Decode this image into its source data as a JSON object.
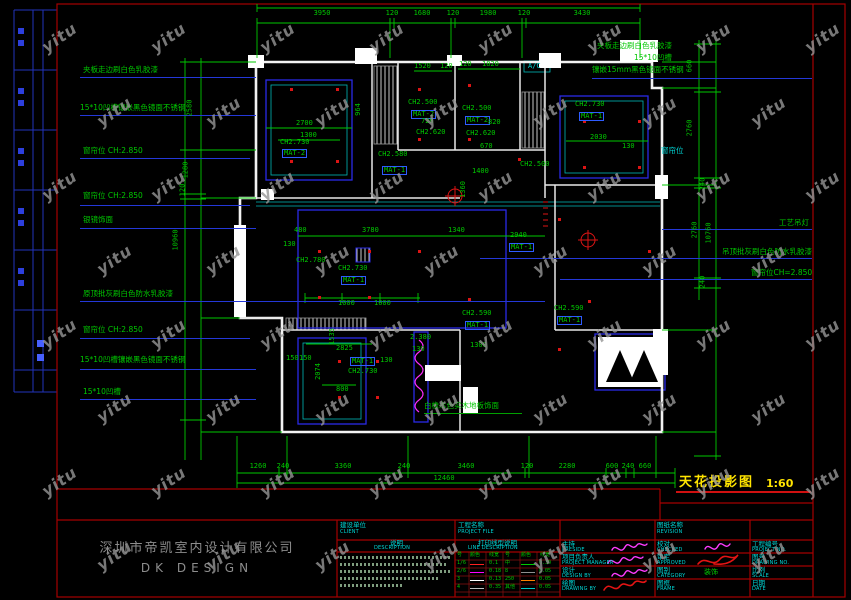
{
  "watermark": {
    "text": "yitu"
  },
  "drawing_title": {
    "name": "天花投影图",
    "scale": "1:60"
  },
  "company": {
    "cn": "深圳市帝凯室内设计有限公司",
    "en": "DK    DESIGN"
  },
  "colors": {
    "dim_green": "#00c800",
    "line_cyan": "#00c2c2",
    "wall_white": "#f2f2f2",
    "frame_red": "#a50000",
    "accent_blue": "#2a2ae6",
    "highlight_yellow": "#ffe400",
    "signature_magenta": "#ff3cff",
    "watermark_gray": "#969696"
  },
  "annotations": {
    "left": [
      {
        "t": "夹板走边刷白色乳胶漆",
        "x": 83,
        "y": 66,
        "ly": 77,
        "lx1": 80,
        "lx2": 256
      },
      {
        "t": "15*10凹槽镶嵌黑色镜面不锈钢",
        "x": 80,
        "y": 104,
        "ly": 115,
        "lx1": 80,
        "lx2": 256
      },
      {
        "t": "窗帘位 CH:2.850",
        "x": 83,
        "y": 147,
        "ly": 158,
        "lx1": 80,
        "lx2": 250
      },
      {
        "t": "窗帘位 CH:2.850",
        "x": 83,
        "y": 192,
        "ly": 205,
        "lx1": 80,
        "lx2": 250
      },
      {
        "t": "银镜饰面",
        "x": 83,
        "y": 216,
        "ly": 228,
        "lx1": 80,
        "lx2": 256
      },
      {
        "t": "原顶批灰刷白色防水乳胶漆",
        "x": 83,
        "y": 290,
        "ly": 301,
        "lx1": 80,
        "lx2": 545
      },
      {
        "t": "窗帘位 CH:2.850",
        "x": 83,
        "y": 326,
        "ly": 338,
        "lx1": 80,
        "lx2": 250
      },
      {
        "t": "15*10凹槽镶嵌黑色镜面不锈钢",
        "x": 80,
        "y": 356,
        "ly": 369,
        "lx1": 80,
        "lx2": 256
      },
      {
        "t": "15*10凹槽",
        "x": 83,
        "y": 388,
        "ly": 399,
        "lx1": 80,
        "lx2": 256
      }
    ],
    "right": [
      {
        "t": "夹板走边刷白色乳胶漆",
        "x": 597,
        "y": 42
      },
      {
        "t": "15*10凹槽",
        "x": 634,
        "y": 54
      },
      {
        "t": "镶嵌15mm黑色镜面不锈钢",
        "x": 592,
        "y": 66,
        "ly": 78,
        "lx1": 592,
        "lx2": 812
      },
      {
        "t": "窗帘位",
        "x": 661,
        "y": 147,
        "c": "cy"
      },
      {
        "t": "工艺吊灯",
        "x": 779,
        "y": 219,
        "ly": 229,
        "lx1": 662,
        "lx2": 812
      },
      {
        "t": "吊顶批灰刷白色防水乳胶漆",
        "x": 722,
        "y": 248,
        "ly": 258,
        "lx1": 480,
        "lx2": 812
      },
      {
        "t": "窗帘位CH=2.850",
        "x": 751,
        "y": 269,
        "ly": 279,
        "lx1": 560,
        "lx2": 812
      }
    ]
  },
  "floor_note": {
    "t": "白橡本色实木地板饰面",
    "x": 424,
    "y": 402,
    "uy": 413,
    "ux1": 424,
    "ux2": 522
  },
  "dims": {
    "top": [
      {
        "t": "3950",
        "x": 322
      },
      {
        "t": "120",
        "x": 392
      },
      {
        "t": "1680",
        "x": 422
      },
      {
        "t": "120",
        "x": 453
      },
      {
        "t": "1980",
        "x": 488
      },
      {
        "t": "120",
        "x": 524
      },
      {
        "t": "3430",
        "x": 582
      }
    ],
    "top_y": 10,
    "bottom": [
      {
        "t": "1260",
        "x": 258
      },
      {
        "t": "240",
        "x": 283
      },
      {
        "t": "3360",
        "x": 343
      },
      {
        "t": "240",
        "x": 404
      },
      {
        "t": "3460",
        "x": 466
      },
      {
        "t": "120",
        "x": 527
      },
      {
        "t": "2280",
        "x": 567
      },
      {
        "t": "600",
        "x": 612
      },
      {
        "t": "240",
        "x": 628
      },
      {
        "t": "660",
        "x": 645
      }
    ],
    "bottom_y": 463,
    "bottom_total": {
      "t": "12460",
      "x": 444,
      "y": 475
    },
    "left": [
      {
        "t": "2580",
        "x": 190,
        "y": 108
      },
      {
        "t": "1280",
        "x": 186,
        "y": 170
      },
      {
        "t": "120",
        "x": 183,
        "y": 190
      },
      {
        "t": "10960",
        "x": 176,
        "y": 240
      }
    ],
    "right": [
      {
        "t": "660",
        "x": 690,
        "y": 66
      },
      {
        "t": "2760",
        "x": 690,
        "y": 128
      },
      {
        "t": "240",
        "x": 703,
        "y": 184
      },
      {
        "t": "2760",
        "x": 695,
        "y": 230
      },
      {
        "t": "10760",
        "x": 709,
        "y": 233
      },
      {
        "t": "240",
        "x": 703,
        "y": 282
      }
    ]
  },
  "plan_labels": [
    {
      "t": "CH2.730",
      "x": 280,
      "y": 139
    },
    {
      "t": "MAT-2",
      "x": 282,
      "y": 149,
      "b": 1
    },
    {
      "t": "2700",
      "x": 296,
      "y": 120
    },
    {
      "t": "1300",
      "x": 300,
      "y": 132
    },
    {
      "t": "964",
      "x": 352,
      "y": 106,
      "v": 1
    },
    {
      "t": "CH2.580",
      "x": 378,
      "y": 151
    },
    {
      "t": "MAT-1",
      "x": 382,
      "y": 166,
      "b": 1
    },
    {
      "t": "CH2.500",
      "x": 408,
      "y": 99
    },
    {
      "t": "MAT-2",
      "x": 411,
      "y": 110,
      "b": 1
    },
    {
      "t": "1520",
      "x": 414,
      "y": 63
    },
    {
      "t": "120",
      "x": 440,
      "y": 63
    },
    {
      "t": "720",
      "x": 421,
      "y": 118
    },
    {
      "t": "CH2.620",
      "x": 416,
      "y": 129
    },
    {
      "t": "120",
      "x": 459,
      "y": 61
    },
    {
      "t": "1820",
      "x": 482,
      "y": 61
    },
    {
      "t": "CH2.500",
      "x": 462,
      "y": 105
    },
    {
      "t": "MAT-2",
      "x": 465,
      "y": 116,
      "b": 1
    },
    {
      "t": "820",
      "x": 488,
      "y": 119
    },
    {
      "t": "CH2.620",
      "x": 466,
      "y": 130
    },
    {
      "t": "A/C",
      "x": 528,
      "y": 63,
      "c": "cy"
    },
    {
      "t": "CH2.730",
      "x": 575,
      "y": 101
    },
    {
      "t": "MAT-1",
      "x": 579,
      "y": 112,
      "b": 1
    },
    {
      "t": "670",
      "x": 480,
      "y": 143
    },
    {
      "t": "2030",
      "x": 590,
      "y": 134
    },
    {
      "t": "130",
      "x": 622,
      "y": 143
    },
    {
      "t": "1400",
      "x": 472,
      "y": 168
    },
    {
      "t": "1360",
      "x": 455,
      "y": 186,
      "v": 1
    },
    {
      "t": "CH2.500",
      "x": 520,
      "y": 161
    },
    {
      "t": "CH2.780",
      "x": 296,
      "y": 257
    },
    {
      "t": "CH2.730",
      "x": 338,
      "y": 265
    },
    {
      "t": "MAT-1",
      "x": 341,
      "y": 276,
      "b": 1
    },
    {
      "t": "3780",
      "x": 362,
      "y": 227
    },
    {
      "t": "1340",
      "x": 448,
      "y": 227
    },
    {
      "t": "480",
      "x": 294,
      "y": 227
    },
    {
      "t": "130",
      "x": 283,
      "y": 241
    },
    {
      "t": "1000",
      "x": 338,
      "y": 300
    },
    {
      "t": "1000",
      "x": 374,
      "y": 300
    },
    {
      "t": "2940",
      "x": 510,
      "y": 232
    },
    {
      "t": "MAT-1",
      "x": 509,
      "y": 243,
      "b": 1
    },
    {
      "t": "CH2.590",
      "x": 462,
      "y": 310
    },
    {
      "t": "MAT-1",
      "x": 465,
      "y": 321,
      "b": 1
    },
    {
      "t": "1300",
      "x": 470,
      "y": 342
    },
    {
      "t": "CH2.590",
      "x": 554,
      "y": 305
    },
    {
      "t": "MAT-1",
      "x": 557,
      "y": 316,
      "b": 1
    },
    {
      "t": "2825",
      "x": 336,
      "y": 345
    },
    {
      "t": "MAT-1",
      "x": 350,
      "y": 357,
      "b": 1
    },
    {
      "t": "CH2.730",
      "x": 348,
      "y": 368
    },
    {
      "t": "800",
      "x": 336,
      "y": 386
    },
    {
      "t": "150",
      "x": 286,
      "y": 355
    },
    {
      "t": "150",
      "x": 299,
      "y": 355
    },
    {
      "t": "130",
      "x": 380,
      "y": 357
    },
    {
      "t": "2074",
      "x": 310,
      "y": 368,
      "v": 1
    },
    {
      "t": "1535",
      "x": 324,
      "y": 333,
      "v": 1
    },
    {
      "t": "2.380",
      "x": 410,
      "y": 334
    },
    {
      "t": "130",
      "x": 412,
      "y": 346
    }
  ],
  "titleblock": {
    "client_cn": "建设单位",
    "client_en": "CLIENT",
    "desc_cn": "说明",
    "desc_en": "DESCRIPTION",
    "project_cn": "工程名称",
    "project_en": "PROJECT FILE",
    "linedesc_cn": "打印线型说明",
    "linedesc_en": "LINE DESCRIPTION",
    "line_table": {
      "headers": [
        "号",
        "颜色",
        "线宽",
        "号",
        "颜色",
        "线宽"
      ],
      "rows": [
        {
          "no": "1/6",
          "w": "0.1",
          "no2": "中",
          "w2": "0.30",
          "c1": "#ff2020",
          "c2": "#00c800"
        },
        {
          "no": "2/6",
          "w": "0.18",
          "no2": "8",
          "w2": "0.05",
          "c1": "#ff00ff",
          "c2": "#909090"
        },
        {
          "no": "3",
          "w": "0.13",
          "no2": "250",
          "w2": "0.05",
          "c1": "#ffffff",
          "c2": "#ff8000"
        },
        {
          "no": "4",
          "w": "0.35",
          "no2": "其他",
          "w2": "0.05",
          "c1": "#c0c0c0",
          "c2": "#00c8c8"
        }
      ]
    },
    "col1": [
      {
        "cn": "主持",
        "en": "PRESIDE"
      },
      {
        "cn": "项目负责人",
        "en": "PROJECT MANAGER"
      },
      {
        "cn": "设计",
        "en": "DESIGN BY"
      },
      {
        "cn": "绘图",
        "en": "DRAWING BY"
      }
    ],
    "col2_header": {
      "cn": "图纸名称",
      "en": "REVISION"
    },
    "col2": [
      {
        "cn": "校对",
        "en": "CHECKED"
      },
      {
        "cn": "审定",
        "en": "APPROVED"
      },
      {
        "cn": "图别",
        "en": "CATEGORY",
        "value": "装饰"
      },
      {
        "cn": "图框",
        "en": "FRAME"
      }
    ],
    "col3": [
      {
        "cn": "工程编号",
        "en": "PROJECT NO."
      },
      {
        "cn": "图号",
        "en": "DRAWING NO."
      },
      {
        "cn": "比例",
        "en": "SCALE"
      },
      {
        "cn": "日期",
        "en": "DATE"
      }
    ]
  }
}
